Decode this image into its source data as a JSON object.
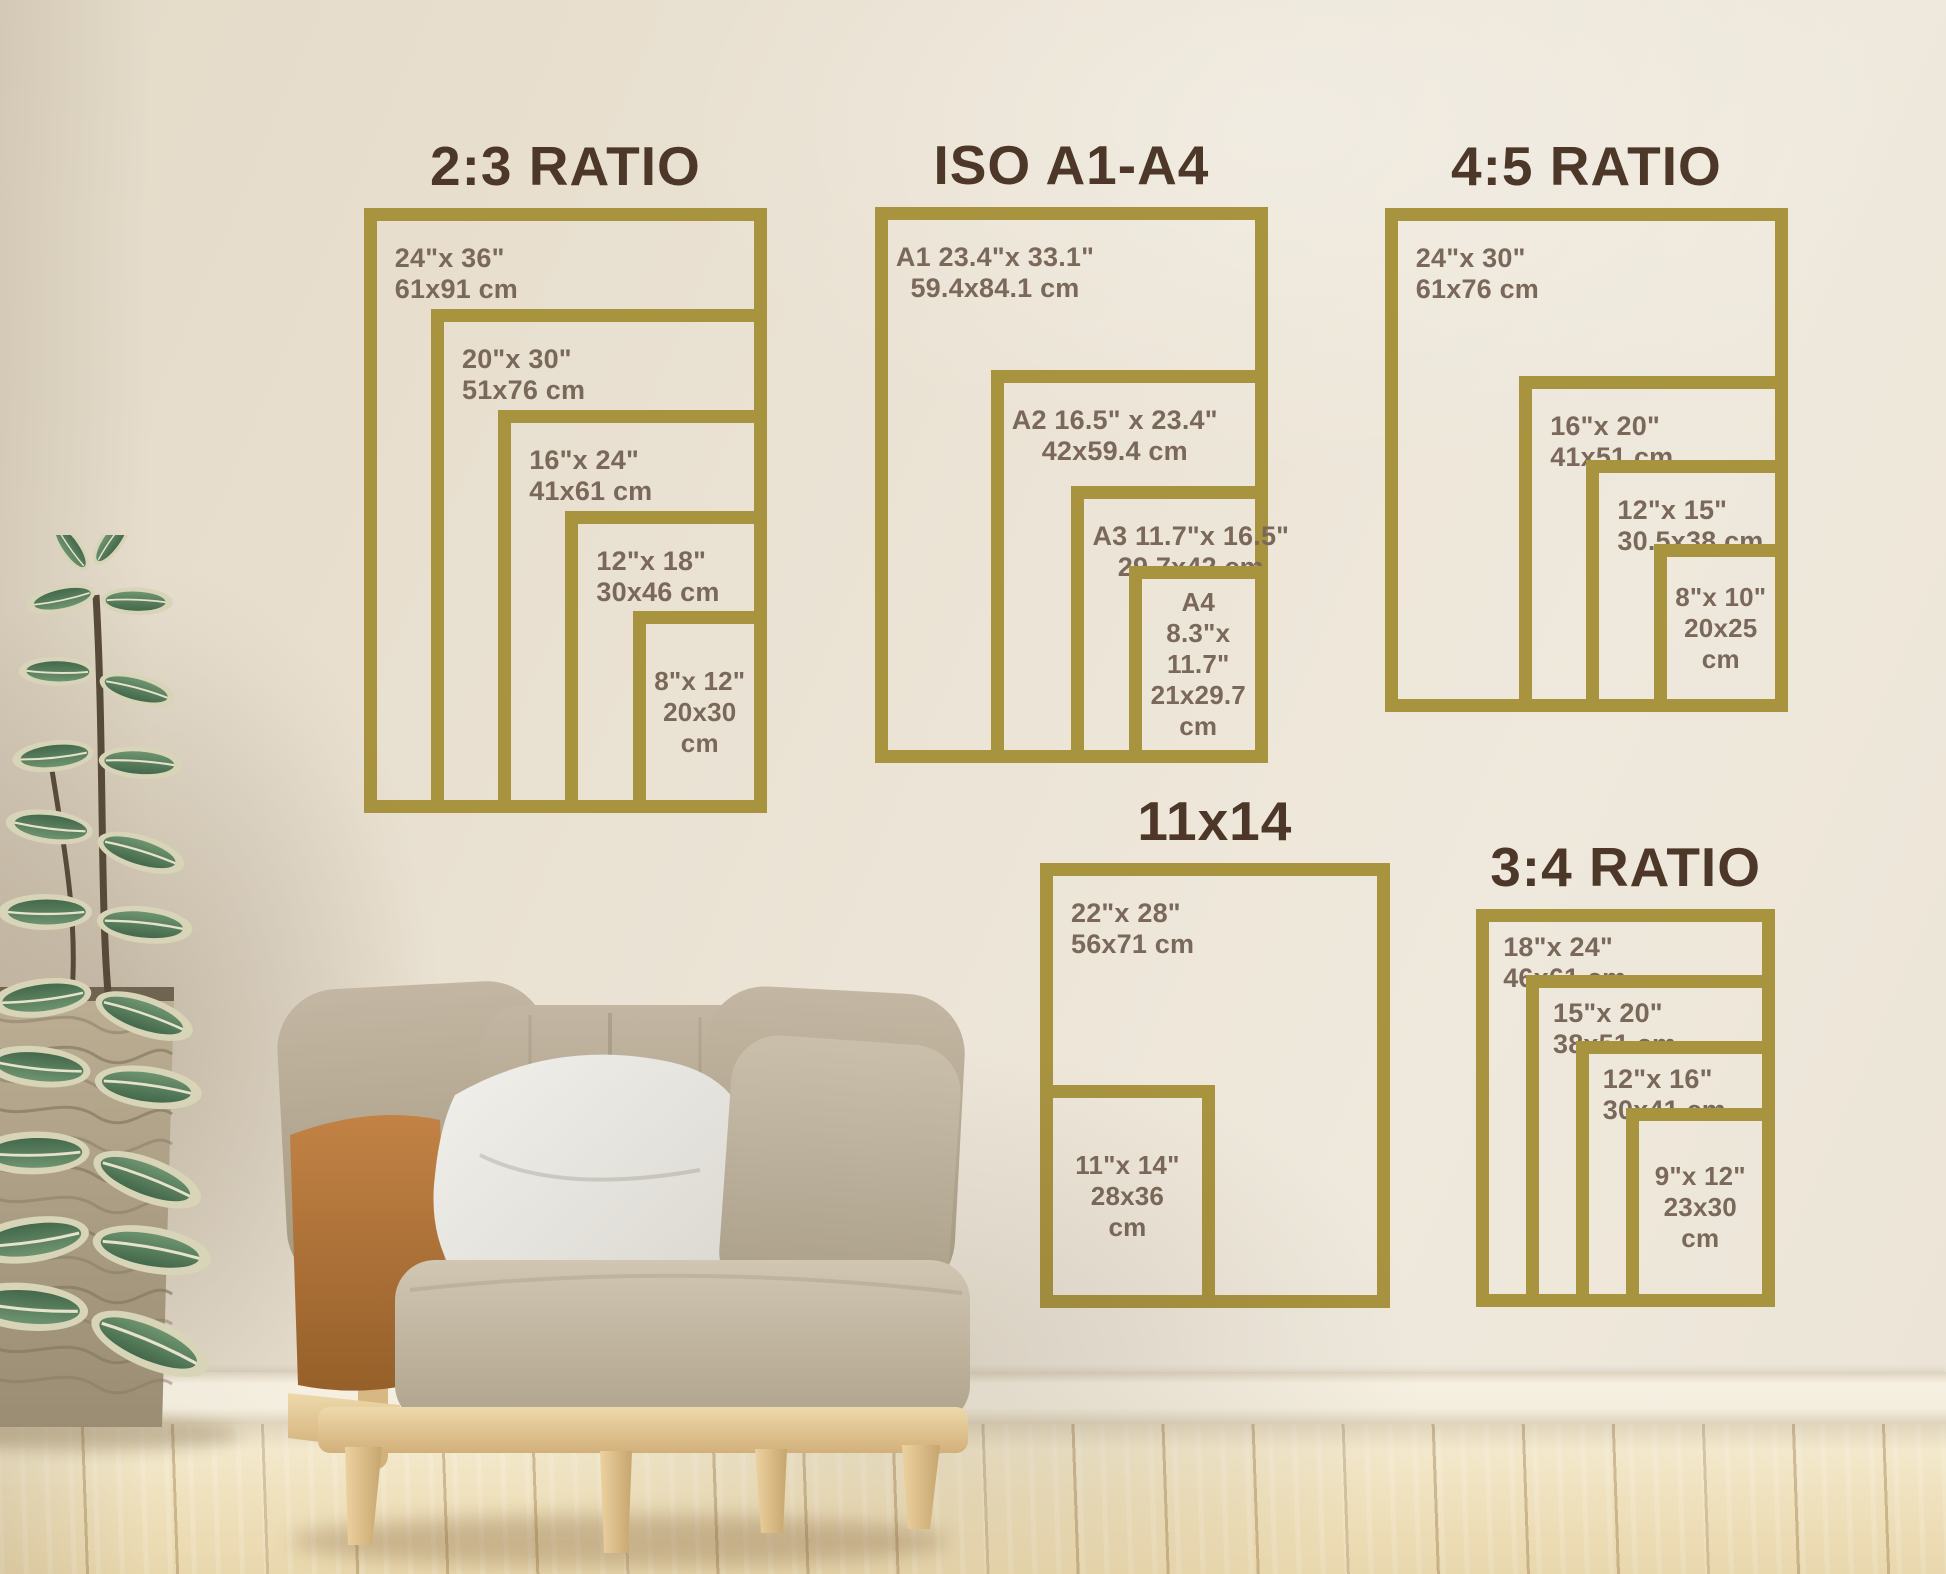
{
  "colors": {
    "frame_gold": "#a8933f",
    "title_brown": "#4c3728",
    "label_brown": "#7a695a",
    "wall_cream": "#ebe3d5",
    "baseboard_cream": "#f4eedf",
    "floor_wood": "#efe1bd",
    "chair_fabric": "#b9ad99",
    "pillow_white": "#edece8",
    "leather_tan": "#b57a3e",
    "wood_light": "#e5c795",
    "leaf_green": "#4e7854",
    "basket_beige": "#b5a88e"
  },
  "sections": [
    {
      "key": "ratio-2-3",
      "title": "2:3 RATIO",
      "anchor": {
        "x": 767,
        "y": 813,
        "corner": "bottom-right"
      },
      "scale": 16.8,
      "label_align": "left",
      "label_offset": {
        "x": 18,
        "y": 22
      },
      "sizes": [
        {
          "w_in": 24,
          "h_in": 36,
          "lines": [
            "24\"x 36\"",
            "61x91 cm"
          ],
          "label": "top-left"
        },
        {
          "w_in": 20,
          "h_in": 30,
          "lines": [
            "20\"x 30\"",
            "51x76 cm"
          ],
          "label": "top-left"
        },
        {
          "w_in": 16,
          "h_in": 24,
          "lines": [
            "16\"x 24\"",
            "41x61 cm"
          ],
          "label": "top-left"
        },
        {
          "w_in": 12,
          "h_in": 18,
          "lines": [
            "12\"x 18\"",
            "30x46 cm"
          ],
          "label": "top-left"
        },
        {
          "w_in": 8,
          "h_in": 12,
          "lines": [
            "8\"x 12\"",
            "20x30 cm"
          ],
          "label": "center"
        }
      ]
    },
    {
      "key": "iso-a1-a4",
      "title": "ISO A1-A4",
      "anchor": {
        "x": 1268,
        "y": 763,
        "corner": "bottom-right"
      },
      "scale": 16.8,
      "label_align": "center",
      "label_offset": {
        "x": 8,
        "y": 22
      },
      "sizes": [
        {
          "w_in": 23.4,
          "h_in": 33.1,
          "lines": [
            "A1 23.4\"x 33.1\"",
            "59.4x84.1 cm"
          ],
          "label": "top-left"
        },
        {
          "w_in": 16.5,
          "h_in": 23.4,
          "lines": [
            "A2 16.5\" x 23.4\"",
            "42x59.4 cm"
          ],
          "label": "top-left"
        },
        {
          "w_in": 11.7,
          "h_in": 16.5,
          "lines": [
            "A3 11.7\"x 16.5\"",
            "29.7x42 cm"
          ],
          "label": "top-left"
        },
        {
          "w_in": 8.3,
          "h_in": 11.7,
          "lines": [
            "A4",
            "8.3\"x 11.7\"",
            "21x29.7",
            "cm"
          ],
          "label": "center"
        }
      ]
    },
    {
      "key": "ratio-4-5",
      "title": "4:5 RATIO",
      "anchor": {
        "x": 1788,
        "y": 712,
        "corner": "bottom-right"
      },
      "scale": 16.8,
      "label_align": "left",
      "label_offset": {
        "x": 18,
        "y": 22
      },
      "sizes": [
        {
          "w_in": 24,
          "h_in": 30,
          "lines": [
            "24\"x 30\"",
            "61x76 cm"
          ],
          "label": "top-left"
        },
        {
          "w_in": 16,
          "h_in": 20,
          "lines": [
            "16\"x 20\"",
            "41x51 cm"
          ],
          "label": "top-left"
        },
        {
          "w_in": 12,
          "h_in": 15,
          "lines": [
            "12\"x 15\"",
            "30.5x38 cm"
          ],
          "label": "top-left"
        },
        {
          "w_in": 8,
          "h_in": 10,
          "lines": [
            "8\"x 10\"",
            "20x25",
            "cm"
          ],
          "label": "center"
        }
      ]
    },
    {
      "key": "11x14",
      "title": "11x14",
      "anchor": {
        "x": 1040,
        "y": 1308,
        "corner": "bottom-left"
      },
      "scale": 15.9,
      "label_align": "left",
      "label_offset": {
        "x": 18,
        "y": 22
      },
      "sizes": [
        {
          "w_in": 22,
          "h_in": 28,
          "lines": [
            "22\"x 28\"",
            "56x71 cm"
          ],
          "label": "top-left"
        },
        {
          "w_in": 11,
          "h_in": 14,
          "lines": [
            "11\"x 14\"",
            "28x36",
            "cm"
          ],
          "label": "center"
        }
      ]
    },
    {
      "key": "ratio-3-4",
      "title": "3:4 RATIO",
      "anchor": {
        "x": 1775,
        "y": 1307,
        "corner": "bottom-right"
      },
      "scale": 16.6,
      "label_align": "left",
      "label_offset": {
        "x": 14,
        "y": 10
      },
      "sizes": [
        {
          "w_in": 18,
          "h_in": 24,
          "lines": [
            "18\"x 24\"",
            "46x61 cm"
          ],
          "label": "top-left"
        },
        {
          "w_in": 15,
          "h_in": 20,
          "lines": [
            "15\"x 20\"",
            "38x51 cm"
          ],
          "label": "top-left"
        },
        {
          "w_in": 12,
          "h_in": 16,
          "lines": [
            "12\"x 16\"",
            "30x41 cm"
          ],
          "label": "top-left"
        },
        {
          "w_in": 9,
          "h_in": 12,
          "lines": [
            "9\"x 12\"",
            "23x30",
            "cm"
          ],
          "label": "center"
        }
      ]
    }
  ]
}
